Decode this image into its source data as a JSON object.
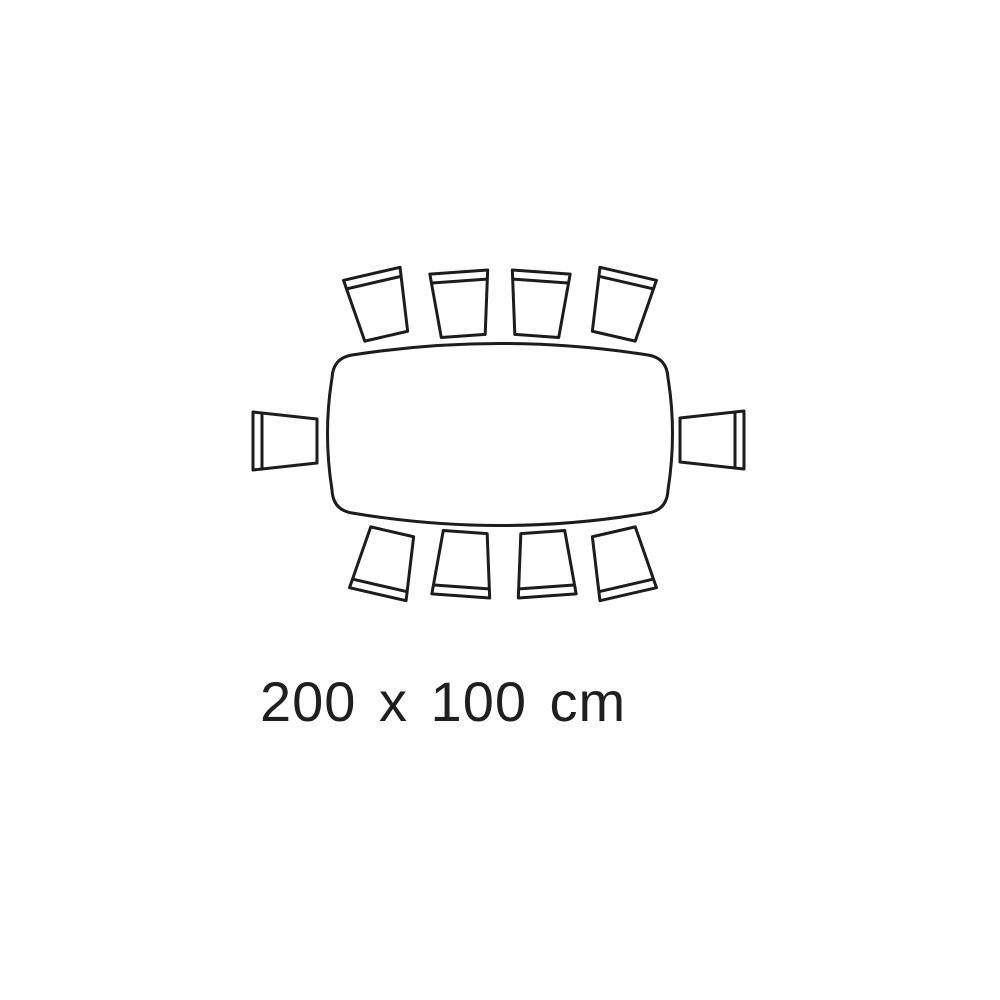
{
  "diagram": {
    "label": "200 x 100 cm",
    "table": {
      "shape": "rounded-rectangle-top-view",
      "width_cm": 200,
      "depth_cm": 100
    },
    "seats": {
      "total": 10,
      "top": 4,
      "bottom": 4,
      "left": 1,
      "right": 1
    },
    "colors": {
      "line": "#1c1c1c",
      "background": "#ffffff"
    }
  }
}
